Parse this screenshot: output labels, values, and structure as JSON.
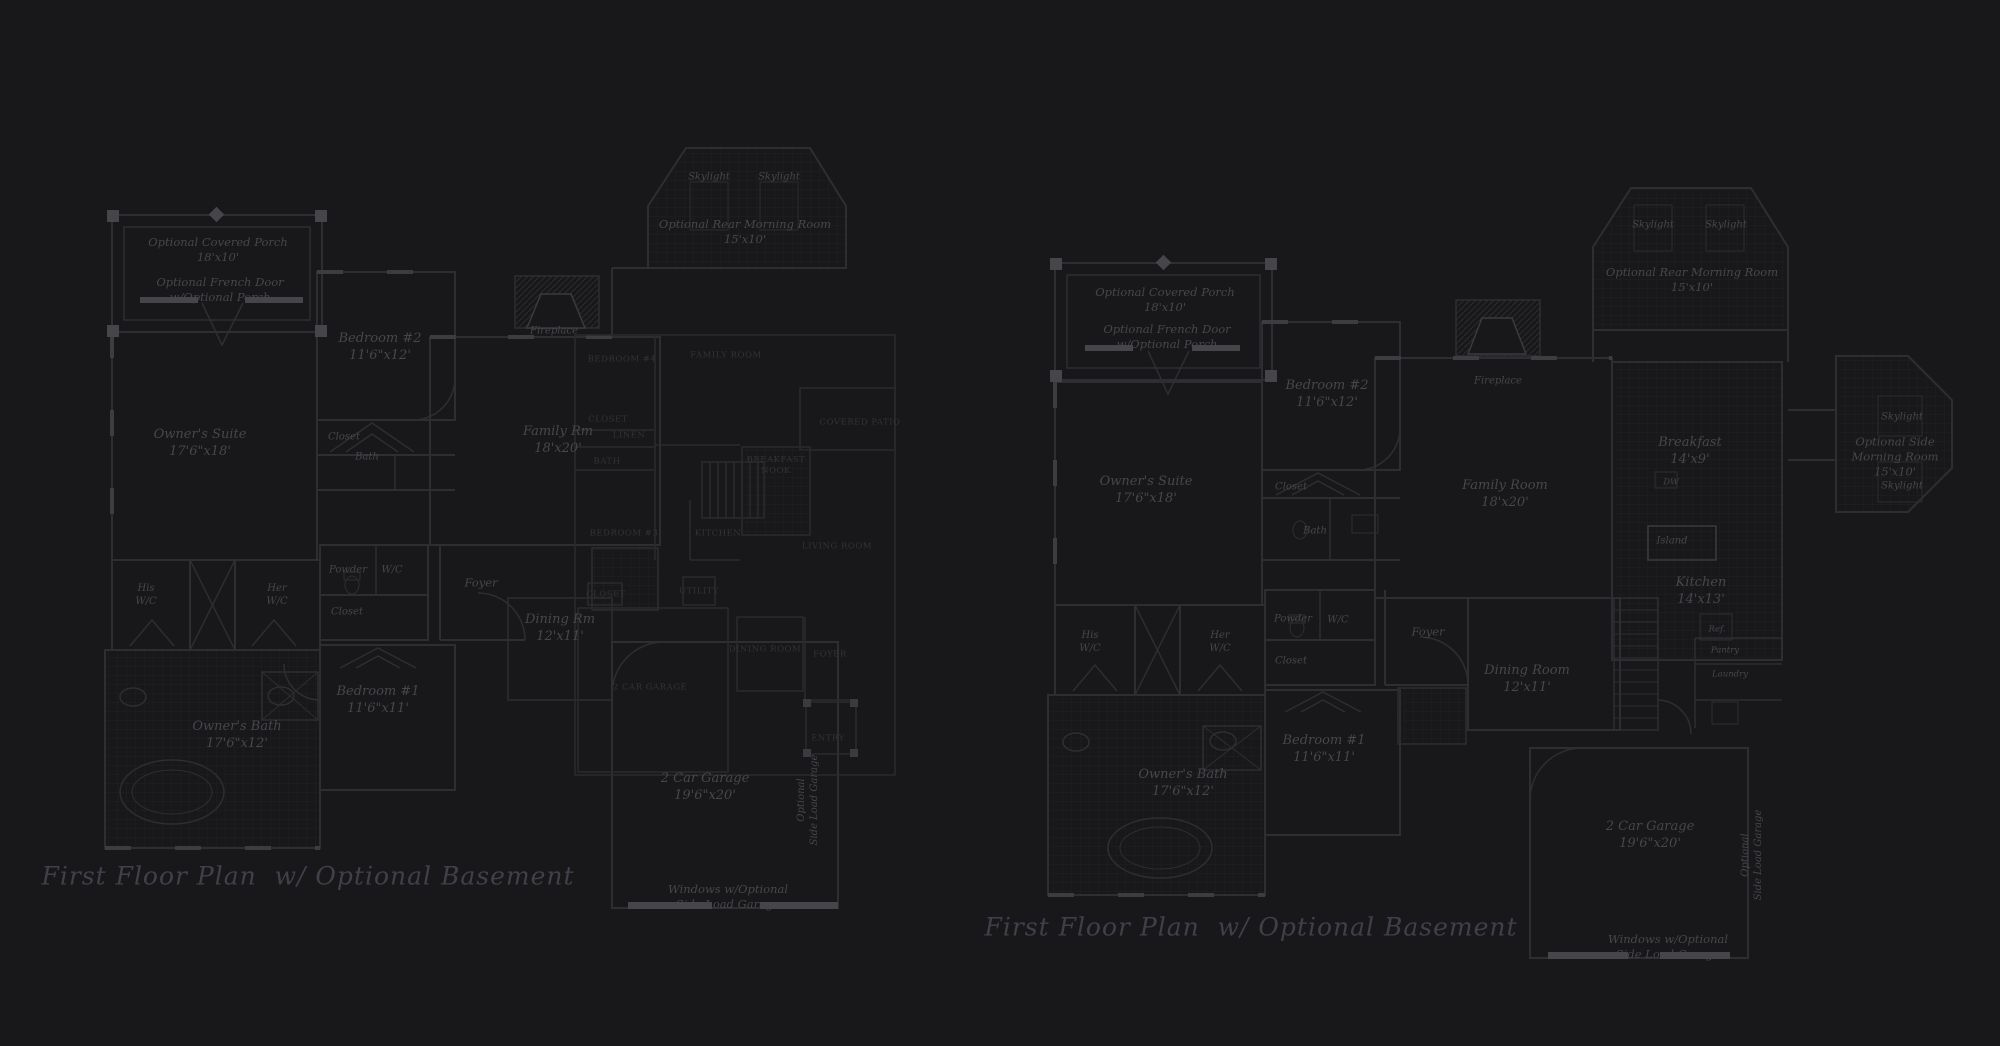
{
  "canvas": {
    "width": 2000,
    "height": 1046,
    "bg": "#18181a"
  },
  "colors": {
    "background": "#18181a",
    "wall_line": "#2e2e32",
    "wall_bright": "#45454a",
    "tile_grid": "#202024",
    "room_label": "#46464c",
    "overlay_label": "#323238",
    "title_text": "#40404a"
  },
  "plans": [
    {
      "name": "left-first-floor-plan",
      "title": "First Floor Plan  w/ Optional Basement",
      "labels": [
        {
          "name": "covered-porch-label",
          "cls": "rm11",
          "x": 218,
          "y": 250,
          "text": "Optional Covered Porch\n18'x10'"
        },
        {
          "name": "french-door-label",
          "cls": "rm11",
          "x": 220,
          "y": 290,
          "text": "Optional French Door\nw/Optional Porch"
        },
        {
          "name": "bedroom2-label",
          "cls": "room",
          "x": 380,
          "y": 348,
          "text": "Bedroom #2\n11'6\"x12'"
        },
        {
          "name": "closet-label",
          "cls": "small",
          "x": 344,
          "y": 437,
          "text": "Closet"
        },
        {
          "name": "bath-label",
          "cls": "small",
          "x": 367,
          "y": 457,
          "text": "Bath"
        },
        {
          "name": "owners-suite-label",
          "cls": "room",
          "x": 200,
          "y": 444,
          "text": "Owner's Suite\n17'6\"x18'"
        },
        {
          "name": "skylight-label",
          "cls": "small",
          "x": 709,
          "y": 177,
          "text": "Skylight"
        },
        {
          "name": "skylight-label",
          "cls": "small",
          "x": 779,
          "y": 177,
          "text": "Skylight"
        },
        {
          "name": "rear-morning-room-label",
          "cls": "rm11",
          "x": 745,
          "y": 232,
          "text": "Optional Rear Morning Room\n15'x10'"
        },
        {
          "name": "fireplace-label",
          "cls": "small",
          "x": 554,
          "y": 331,
          "text": "Fireplace"
        },
        {
          "name": "family-room-label",
          "cls": "room",
          "x": 558,
          "y": 441,
          "text": "Family Rm\n18'x20'"
        },
        {
          "name": "his-wc-label",
          "cls": "small",
          "x": 146,
          "y": 595,
          "text": "His\nW/C"
        },
        {
          "name": "her-wc-label",
          "cls": "small",
          "x": 277,
          "y": 595,
          "text": "Her\nW/C"
        },
        {
          "name": "powder-label",
          "cls": "small",
          "x": 348,
          "y": 570,
          "text": "Powder"
        },
        {
          "name": "wc-label",
          "cls": "small",
          "x": 392,
          "y": 570,
          "text": "W/C"
        },
        {
          "name": "closet-label",
          "cls": "small",
          "x": 347,
          "y": 612,
          "text": "Closet"
        },
        {
          "name": "foyer-label",
          "cls": "rm11",
          "x": 481,
          "y": 583,
          "text": "Foyer"
        },
        {
          "name": "dining-room-label",
          "cls": "room",
          "x": 560,
          "y": 629,
          "text": "Dining Rm\n12'x11'"
        },
        {
          "name": "bedroom1-label",
          "cls": "room",
          "x": 378,
          "y": 701,
          "text": "Bedroom #1\n11'6\"x11'"
        },
        {
          "name": "owners-bath-label",
          "cls": "room",
          "x": 237,
          "y": 736,
          "text": "Owner's Bath\n17'6\"x12'"
        },
        {
          "name": "garage-label",
          "cls": "room",
          "x": 705,
          "y": 788,
          "text": "2 Car Garage\n19'6\"x20'"
        },
        {
          "name": "side-load-garage-label",
          "cls": "vert",
          "x": 808,
          "y": 800,
          "text": "Optional\nSide Load Garage"
        },
        {
          "name": "windows-note-label",
          "cls": "rm11",
          "x": 728,
          "y": 897,
          "text": "Windows w/Optional\nSide Load Garage"
        }
      ]
    },
    {
      "name": "center-overlay-plan",
      "labels": [
        {
          "name": "bedroom4-label",
          "cls": "caps",
          "x": 622,
          "y": 360,
          "text": "BEDROOM #4"
        },
        {
          "name": "family-room-label",
          "cls": "caps",
          "x": 726,
          "y": 356,
          "text": "FAMILY ROOM"
        },
        {
          "name": "closet-label",
          "cls": "caps",
          "x": 608,
          "y": 420,
          "text": "CLOSET"
        },
        {
          "name": "linen-label",
          "cls": "caps",
          "x": 629,
          "y": 436,
          "text": "LINEN"
        },
        {
          "name": "bath-label",
          "cls": "caps",
          "x": 607,
          "y": 462,
          "text": "BATH"
        },
        {
          "name": "covered-patio-label",
          "cls": "caps",
          "x": 860,
          "y": 423,
          "text": "COVERED PATIO"
        },
        {
          "name": "breakfast-nook-label",
          "cls": "caps",
          "x": 776,
          "y": 466,
          "text": "BREAKFAST\nNOOK"
        },
        {
          "name": "kitchen-label",
          "cls": "caps",
          "x": 718,
          "y": 534,
          "text": "KITCHEN"
        },
        {
          "name": "bedroom3-label",
          "cls": "caps",
          "x": 624,
          "y": 534,
          "text": "BEDROOM #3"
        },
        {
          "name": "living-room-label",
          "cls": "caps",
          "x": 837,
          "y": 547,
          "text": "LIVING ROOM"
        },
        {
          "name": "closet-label",
          "cls": "caps",
          "x": 606,
          "y": 595,
          "text": "CLOSET"
        },
        {
          "name": "utility-label",
          "cls": "caps",
          "x": 699,
          "y": 592,
          "text": "UTILITY"
        },
        {
          "name": "garage-label",
          "cls": "caps",
          "x": 650,
          "y": 688,
          "text": "2 CAR GARAGE"
        },
        {
          "name": "dining-room-label",
          "cls": "caps",
          "x": 765,
          "y": 650,
          "text": "DINING ROOM"
        },
        {
          "name": "foyer-label",
          "cls": "caps",
          "x": 830,
          "y": 655,
          "text": "FOYER"
        },
        {
          "name": "entry-label",
          "cls": "caps",
          "x": 828,
          "y": 739,
          "text": "ENTRY"
        }
      ]
    },
    {
      "name": "right-first-floor-plan",
      "title": "First Floor Plan  w/ Optional Basement",
      "labels": [
        {
          "name": "covered-porch-label",
          "cls": "rm11",
          "x": 1165,
          "y": 300,
          "text": "Optional Covered Porch\n18'x10'"
        },
        {
          "name": "french-door-label",
          "cls": "rm11",
          "x": 1167,
          "y": 337,
          "text": "Optional French Door\nw/Optional Porch"
        },
        {
          "name": "bedroom2-label",
          "cls": "room",
          "x": 1327,
          "y": 395,
          "text": "Bedroom #2\n11'6\"x12'"
        },
        {
          "name": "closet-label",
          "cls": "small",
          "x": 1291,
          "y": 487,
          "text": "Closet"
        },
        {
          "name": "bath-label",
          "cls": "small",
          "x": 1315,
          "y": 531,
          "text": "Bath"
        },
        {
          "name": "owners-suite-label",
          "cls": "room",
          "x": 1146,
          "y": 491,
          "text": "Owner's Suite\n17'6\"x18'"
        },
        {
          "name": "skylight-label",
          "cls": "small",
          "x": 1653,
          "y": 225,
          "text": "Skylight"
        },
        {
          "name": "skylight-label",
          "cls": "small",
          "x": 1726,
          "y": 225,
          "text": "Skylight"
        },
        {
          "name": "rear-morning-room-label",
          "cls": "rm11",
          "x": 1692,
          "y": 280,
          "text": "Optional Rear Morning Room\n15'x10'"
        },
        {
          "name": "fireplace-label",
          "cls": "small",
          "x": 1498,
          "y": 381,
          "text": "Fireplace"
        },
        {
          "name": "family-room-label",
          "cls": "room",
          "x": 1505,
          "y": 495,
          "text": "Family Room\n18'x20'"
        },
        {
          "name": "breakfast-label",
          "cls": "room",
          "x": 1690,
          "y": 452,
          "text": "Breakfast\n14'x9'"
        },
        {
          "name": "dw-label",
          "cls": "tiny",
          "x": 1671,
          "y": 483,
          "text": "DW"
        },
        {
          "name": "island-label",
          "cls": "small",
          "x": 1672,
          "y": 541,
          "text": "Island"
        },
        {
          "name": "kitchen-label",
          "cls": "room",
          "x": 1701,
          "y": 592,
          "text": "Kitchen\n14'x13'"
        },
        {
          "name": "ref-label",
          "cls": "tiny",
          "x": 1717,
          "y": 630,
          "text": "Ref."
        },
        {
          "name": "pantry-label",
          "cls": "tiny",
          "x": 1725,
          "y": 651,
          "text": "Pantry"
        },
        {
          "name": "laundry-label",
          "cls": "tiny",
          "x": 1730,
          "y": 675,
          "text": "Laundry"
        },
        {
          "name": "skylight-label",
          "cls": "small",
          "x": 1902,
          "y": 417,
          "text": "Skylight"
        },
        {
          "name": "side-morning-room-label",
          "cls": "rm11",
          "x": 1895,
          "y": 457,
          "text": "Optional Side\nMorning Room\n15'x10'"
        },
        {
          "name": "skylight-label",
          "cls": "small",
          "x": 1902,
          "y": 486,
          "text": "Skylight"
        },
        {
          "name": "his-wc-label",
          "cls": "small",
          "x": 1090,
          "y": 642,
          "text": "His\nW/C"
        },
        {
          "name": "her-wc-label",
          "cls": "small",
          "x": 1220,
          "y": 642,
          "text": "Her\nW/C"
        },
        {
          "name": "powder-label",
          "cls": "small",
          "x": 1293,
          "y": 619,
          "text": "Powder"
        },
        {
          "name": "wc-label",
          "cls": "small",
          "x": 1338,
          "y": 620,
          "text": "W/C"
        },
        {
          "name": "closet-label",
          "cls": "small",
          "x": 1291,
          "y": 661,
          "text": "Closet"
        },
        {
          "name": "foyer-label",
          "cls": "rm11",
          "x": 1428,
          "y": 632,
          "text": "Foyer"
        },
        {
          "name": "dining-room-label",
          "cls": "room",
          "x": 1527,
          "y": 680,
          "text": "Dining Room\n12'x11'"
        },
        {
          "name": "bedroom1-label",
          "cls": "room",
          "x": 1324,
          "y": 750,
          "text": "Bedroom #1\n11'6\"x11'"
        },
        {
          "name": "owners-bath-label",
          "cls": "room",
          "x": 1183,
          "y": 784,
          "text": "Owner's Bath\n17'6\"x12'"
        },
        {
          "name": "garage-label",
          "cls": "room",
          "x": 1650,
          "y": 836,
          "text": "2 Car Garage\n19'6\"x20'"
        },
        {
          "name": "side-load-garage-label",
          "cls": "vert",
          "x": 1752,
          "y": 855,
          "text": "Optional\nSide Load Garage"
        },
        {
          "name": "windows-note-label",
          "cls": "rm11",
          "x": 1668,
          "y": 947,
          "text": "Windows w/Optional\nSide Load Garage"
        }
      ]
    }
  ]
}
